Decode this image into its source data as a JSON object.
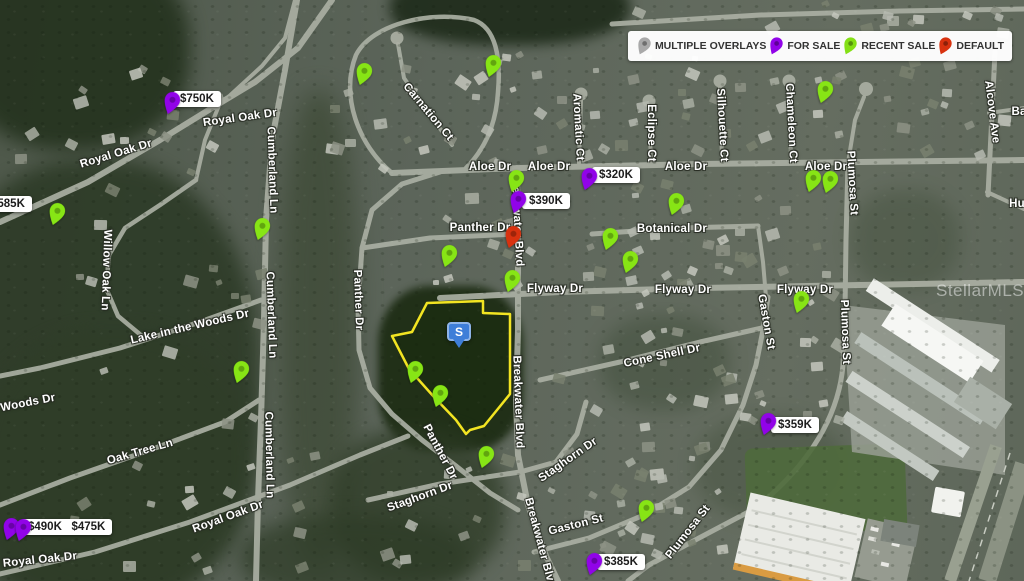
{
  "map": {
    "watermark": "StellarMLS",
    "legend": {
      "items": [
        {
          "id": "multiple-overlays",
          "label": "MULTIPLE OVERLAYS",
          "color": "#a9a9a9"
        },
        {
          "id": "for-sale",
          "label": "FOR SALE",
          "color": "#9103e8"
        },
        {
          "id": "recent-sale",
          "label": "RECENT SALE",
          "color": "#84e015"
        },
        {
          "id": "default",
          "label": "DEFAULT",
          "color": "#d8320f"
        }
      ]
    },
    "pin_colors": {
      "for_sale": "#9103e8",
      "recent_sale": "#87e515",
      "default": "#d8320f",
      "multiple": "#a9a9a9"
    },
    "subject_marker": {
      "label": "S",
      "x": 459,
      "y": 322,
      "color": "#3e7ed8"
    },
    "parcel": {
      "outline_color": "#f2e422",
      "points": "427,303 483,301 483,313 510,314 510,394 484,426 470,430 466,434 456,420 434,397 409,369 392,336 412,332"
    },
    "price_labels": [
      {
        "texts": [
          "$750K"
        ],
        "x": 173,
        "y": 91
      },
      {
        "texts": [
          "$585K"
        ],
        "x": -16,
        "y": 196
      },
      {
        "texts": [
          "$390K"
        ],
        "x": 522,
        "y": 193
      },
      {
        "texts": [
          "$320K"
        ],
        "x": 592,
        "y": 167
      },
      {
        "texts": [
          "$359K"
        ],
        "x": 771,
        "y": 417
      },
      {
        "texts": [
          "$385K"
        ],
        "x": 597,
        "y": 554
      },
      {
        "texts": [
          "$490K",
          "$475K"
        ],
        "x": 21,
        "y": 519
      }
    ],
    "pins": [
      {
        "type": "for_sale",
        "x": 167,
        "y": 115
      },
      {
        "type": "for_sale",
        "x": 6,
        "y": 541
      },
      {
        "type": "for_sale",
        "x": 18,
        "y": 542
      },
      {
        "type": "for_sale",
        "x": 513,
        "y": 214
      },
      {
        "type": "for_sale",
        "x": 584,
        "y": 191
      },
      {
        "type": "for_sale",
        "x": 763,
        "y": 436
      },
      {
        "type": "for_sale",
        "x": 589,
        "y": 576
      },
      {
        "type": "default",
        "x": 508,
        "y": 249
      },
      {
        "type": "recent_sale",
        "x": 52,
        "y": 226
      },
      {
        "type": "recent_sale",
        "x": 257,
        "y": 241
      },
      {
        "type": "recent_sale",
        "x": 236,
        "y": 384
      },
      {
        "type": "recent_sale",
        "x": 359,
        "y": 86
      },
      {
        "type": "recent_sale",
        "x": 488,
        "y": 78
      },
      {
        "type": "recent_sale",
        "x": 511,
        "y": 193
      },
      {
        "type": "recent_sale",
        "x": 671,
        "y": 216
      },
      {
        "type": "recent_sale",
        "x": 605,
        "y": 251
      },
      {
        "type": "recent_sale",
        "x": 625,
        "y": 274
      },
      {
        "type": "recent_sale",
        "x": 507,
        "y": 293
      },
      {
        "type": "recent_sale",
        "x": 444,
        "y": 268
      },
      {
        "type": "recent_sale",
        "x": 410,
        "y": 384
      },
      {
        "type": "recent_sale",
        "x": 435,
        "y": 408
      },
      {
        "type": "recent_sale",
        "x": 481,
        "y": 469
      },
      {
        "type": "recent_sale",
        "x": 796,
        "y": 314
      },
      {
        "type": "recent_sale",
        "x": 808,
        "y": 193
      },
      {
        "type": "recent_sale",
        "x": 825,
        "y": 194
      },
      {
        "type": "recent_sale",
        "x": 820,
        "y": 104
      },
      {
        "type": "recent_sale",
        "x": 641,
        "y": 523
      }
    ],
    "street_labels": [
      {
        "t": "Royal Oak Dr",
        "x": 240,
        "y": 118,
        "r": -8
      },
      {
        "t": "Royal Oak Dr",
        "x": 116,
        "y": 154,
        "r": -17
      },
      {
        "t": "Royal Oak Dr",
        "x": 228,
        "y": 517,
        "r": -20
      },
      {
        "t": "Royal Oak Dr",
        "x": 40,
        "y": 560,
        "r": -6
      },
      {
        "t": "Cumberland Ln",
        "x": 272,
        "y": 170,
        "r": 88
      },
      {
        "t": "Cumberland Ln",
        "x": 271,
        "y": 315,
        "r": 88
      },
      {
        "t": "Cumberland Ln",
        "x": 269,
        "y": 455,
        "r": 89
      },
      {
        "t": "Willow Oak Ln",
        "x": 106,
        "y": 270,
        "r": 92
      },
      {
        "t": "Lake in the Woods Dr",
        "x": 190,
        "y": 327,
        "r": -13
      },
      {
        "t": "Woods Dr",
        "x": 28,
        "y": 403,
        "r": -11
      },
      {
        "t": "Oak Tree Ln",
        "x": 140,
        "y": 452,
        "r": -16
      },
      {
        "t": "Panther Dr",
        "x": 358,
        "y": 300,
        "r": 88
      },
      {
        "t": "Panther Dr",
        "x": 480,
        "y": 228,
        "r": 0
      },
      {
        "t": "Panther Dr",
        "x": 440,
        "y": 452,
        "r": 62
      },
      {
        "t": "Carnation Ct",
        "x": 428,
        "y": 112,
        "r": 50
      },
      {
        "t": "Aromatic Ct",
        "x": 578,
        "y": 127,
        "r": 87
      },
      {
        "t": "Eclipse Ct",
        "x": 651,
        "y": 133,
        "r": 90
      },
      {
        "t": "Silhouette Ct",
        "x": 722,
        "y": 125,
        "r": 87
      },
      {
        "t": "Chameleon Ct",
        "x": 791,
        "y": 123,
        "r": 87
      },
      {
        "t": "Alcove Ave",
        "x": 992,
        "y": 112,
        "r": 83
      },
      {
        "t": "Aloe Dr",
        "x": 490,
        "y": 167,
        "r": 0
      },
      {
        "t": "Aloe Dr",
        "x": 549,
        "y": 167,
        "r": 0
      },
      {
        "t": "Aloe Dr",
        "x": 686,
        "y": 167,
        "r": 0
      },
      {
        "t": "Aloe Dr",
        "x": 826,
        "y": 167,
        "r": 0
      },
      {
        "t": "Breakwater Blvd",
        "x": 517,
        "y": 220,
        "r": 87
      },
      {
        "t": "Breakwater Blvd",
        "x": 518,
        "y": 402,
        "r": 88
      },
      {
        "t": "Breakwater Blvd",
        "x": 540,
        "y": 543,
        "r": 75
      },
      {
        "t": "Botanical Dr",
        "x": 672,
        "y": 229,
        "r": 0
      },
      {
        "t": "Flyway Dr",
        "x": 555,
        "y": 289,
        "r": 0
      },
      {
        "t": "Flyway Dr",
        "x": 683,
        "y": 290,
        "r": 0
      },
      {
        "t": "Flyway Dr",
        "x": 805,
        "y": 290,
        "r": 0
      },
      {
        "t": "Cone Shell Dr",
        "x": 662,
        "y": 356,
        "r": -12
      },
      {
        "t": "Gaston St",
        "x": 766,
        "y": 322,
        "r": 80
      },
      {
        "t": "Gaston St",
        "x": 576,
        "y": 525,
        "r": -14
      },
      {
        "t": "Plumosa St",
        "x": 852,
        "y": 183,
        "r": 87
      },
      {
        "t": "Plumosa St",
        "x": 845,
        "y": 332,
        "r": 88
      },
      {
        "t": "Plumosa St",
        "x": 688,
        "y": 532,
        "r": -52
      },
      {
        "t": "Staghorn Dr",
        "x": 568,
        "y": 460,
        "r": -35
      },
      {
        "t": "Staghorn Dr",
        "x": 420,
        "y": 497,
        "r": -20
      },
      {
        "t": "Ba",
        "x": 1019,
        "y": 112,
        "r": 0
      },
      {
        "t": "Hu",
        "x": 1017,
        "y": 204,
        "r": 0
      }
    ]
  }
}
